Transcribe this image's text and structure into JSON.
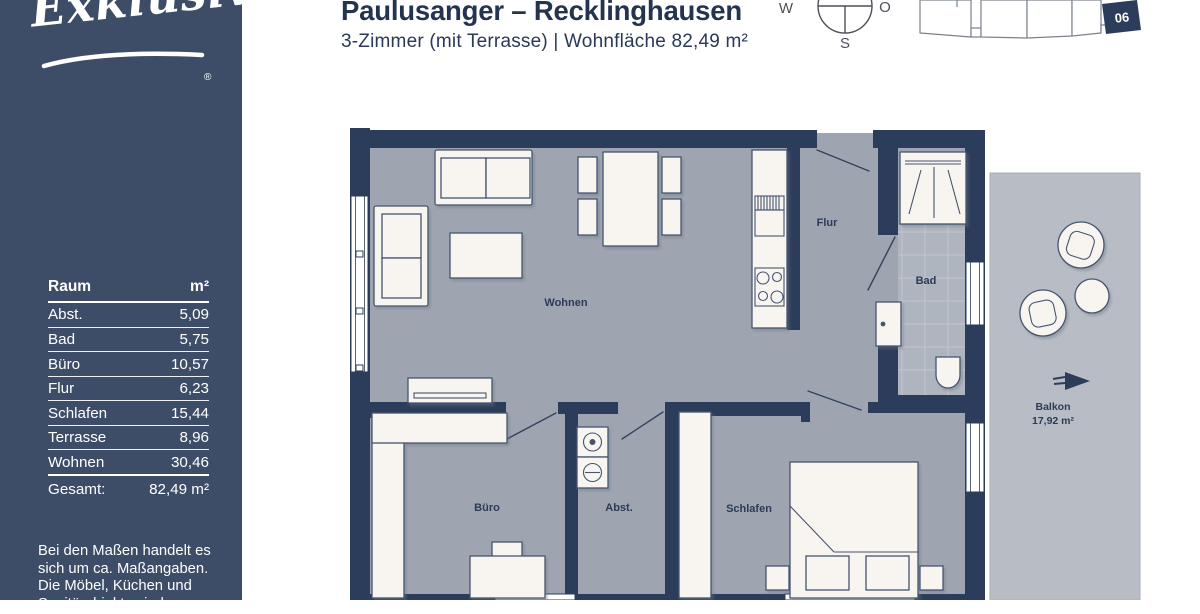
{
  "brand": {
    "logo_text": "Exklusiv",
    "registered_mark": "®"
  },
  "header": {
    "title": "Paulusanger – Recklinghausen",
    "subtitle": "3-Zimmer (mit Terrasse) | Wohnfläche 82,49 m²"
  },
  "compass": {
    "west": "W",
    "east": "O",
    "south": "S"
  },
  "keyplan": {
    "unit_number": "06"
  },
  "room_table": {
    "col_room": "Raum",
    "col_area": "m²",
    "rows": [
      {
        "room": "Abst.",
        "area": "5,09"
      },
      {
        "room": "Bad",
        "area": "5,75"
      },
      {
        "room": "Büro",
        "area": "10,57"
      },
      {
        "room": "Flur",
        "area": "6,23"
      },
      {
        "room": "Schlafen",
        "area": "15,44"
      },
      {
        "room": "Terrasse",
        "area": "8,96"
      },
      {
        "room": "Wohnen",
        "area": "30,46"
      }
    ],
    "total_label": "Gesamt:",
    "total_value": "82,49 m²"
  },
  "disclaimer": {
    "line1": "Bei den Maßen handelt es",
    "line2": "sich um ca. Maßangaben.",
    "line3": "Die Möbel, Küchen und",
    "line4": "Sanitärobjekte sind"
  },
  "plan": {
    "labels": {
      "wohnen": "Wohnen",
      "flur": "Flur",
      "bad": "Bad",
      "buero": "Büro",
      "abstell": "Abst.",
      "schlafen": "Schlafen",
      "balkon": "Balkon",
      "balkon_area": "17,92 m²"
    }
  },
  "colors": {
    "sidebar": "#3E4D67",
    "wall": "#2C3C5B",
    "floor": "#9EA5B1",
    "tiles": "#AFB5BF",
    "balcony": "#B8BDC5",
    "furniture": "#F8F5F0",
    "heading": "#24334F"
  }
}
